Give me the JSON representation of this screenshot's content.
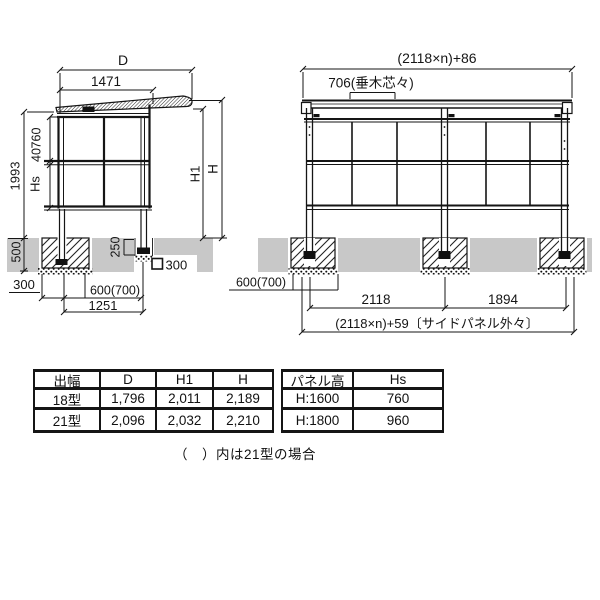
{
  "drawing": {
    "side_view": {
      "dim_d": "D",
      "dim_1471": "1471",
      "dim_1993": "1993",
      "dim_760": "760",
      "dim_40": "40",
      "dim_hs": "Hs",
      "dim_h1": "H1",
      "dim_h": "H",
      "dim_500": "500",
      "dim_250": "250",
      "dim_post_300": "300",
      "dim_300": "300",
      "dim_600_700": "600(700)",
      "dim_1251": "1251"
    },
    "front_view": {
      "dim_total_top": "(2118×n)+86",
      "dim_rafter": "706(垂木芯々)",
      "dim_600_700": "600(700)",
      "dim_2118": "2118",
      "dim_1894": "1894",
      "dim_total_bottom": "(2118×n)+59〔サイドパネル外々〕"
    }
  },
  "spec_table": {
    "headers": [
      "出幅",
      "D",
      "H1",
      "H"
    ],
    "rows": [
      [
        "18型",
        "1,796",
        "2,011",
        "2,189"
      ],
      [
        "21型",
        "2,096",
        "2,032",
        "2,210"
      ]
    ]
  },
  "panel_table": {
    "headers": [
      "パネル高",
      "Hs"
    ],
    "rows": [
      [
        "H:1600",
        "760"
      ],
      [
        "H:1800",
        "960"
      ]
    ]
  },
  "note": "（　）内は21型の場合",
  "colors": {
    "line": "#1a1a1a",
    "ground": "#c8c8c8"
  }
}
